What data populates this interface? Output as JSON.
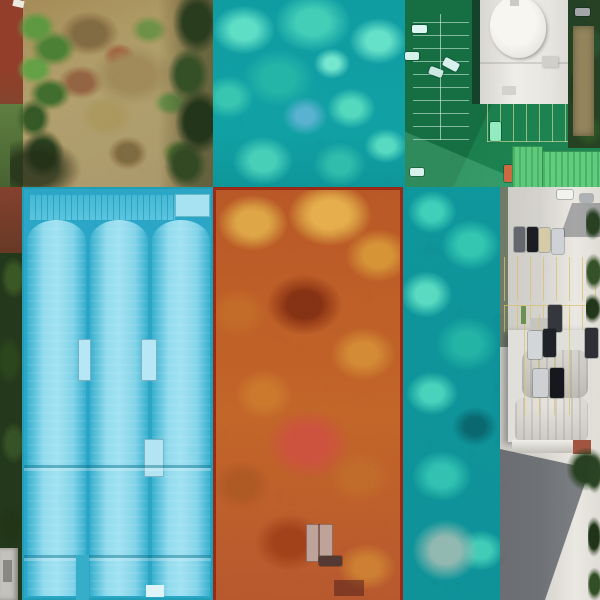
{
  "canvas": {
    "label": "Aerial orthophoto with land-parcel annotation overlays",
    "width": 600,
    "height": 600
  },
  "palette": {
    "overlay-teal": "#0e8a8f",
    "overlay-green": "#166a41",
    "overlay-orange": "#b45522",
    "overlay-blue": "#47bade",
    "orange-border": "#7e1f10",
    "blue-border": "#1b88a6",
    "teal-highlight": "#4fd6b8",
    "green-stall-line": "#bdeecd",
    "yellow-line": "#d2b24e",
    "concrete": "#cbc8c1",
    "roof-white": "#e9e6df",
    "roof-green": "#46ae60",
    "scrub-tan": "#a0895c",
    "dark-tree": "#233219",
    "red-dirt": "#7b3423",
    "red-ground": "#c24534",
    "shadow": "#262c36"
  },
  "annotated_parcels": [
    {
      "id": "forest-teal-top",
      "label": "Tree canopy parcel (teal overlay)",
      "overlay_color": "#0e8a8f",
      "bbox": [
        213,
        0,
        192,
        187
      ]
    },
    {
      "id": "parking-green",
      "label": "Parking lot parcel with sheds (green overlay)",
      "overlay_color": "#166a41",
      "bbox": [
        405,
        0,
        195,
        187
      ]
    },
    {
      "id": "warehouse-blue",
      "label": "Warehouse rooftop parcel, three barrel-vault bays (light-blue overlay)",
      "overlay_color": "#47bade",
      "bbox": [
        22,
        187,
        191,
        413
      ]
    },
    {
      "id": "forest-orange",
      "label": "Tree canopy parcel with small house (orange overlay, dark-red border)",
      "overlay_color": "#b45522",
      "bbox": [
        213,
        187,
        190,
        413
      ]
    },
    {
      "id": "forest-teal-right",
      "label": "Tree canopy strip parcel (teal overlay)",
      "overlay_color": "#0e8a8f",
      "bbox": [
        403,
        187,
        97,
        413
      ]
    }
  ],
  "unannotated_areas": [
    {
      "id": "scrub-field",
      "label": "Bare scrub field with bushes and dirt",
      "bbox": [
        0,
        0,
        213,
        187
      ]
    },
    {
      "id": "white-tower",
      "label": "White tower building with oval roof",
      "bbox": [
        480,
        0,
        88,
        104
      ]
    },
    {
      "id": "left-tree-strip",
      "label": "Tree strip along left edge",
      "bbox": [
        0,
        187,
        23,
        413
      ]
    },
    {
      "id": "right-parking-strip",
      "label": "Concrete parking strip with vaulted-roof building and parked cars",
      "bbox": [
        500,
        187,
        100,
        413
      ]
    }
  ]
}
